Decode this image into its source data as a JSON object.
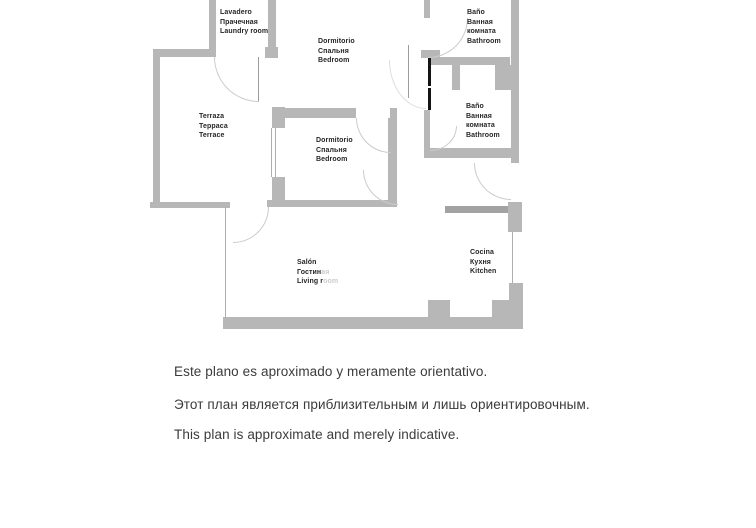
{
  "rooms": {
    "lavadero": {
      "lines": [
        "Lavadero",
        "Прачечная",
        "Laundry room"
      ]
    },
    "dormitorio1": {
      "lines": [
        "Dormitorio",
        "Спальня",
        "Bedroom"
      ]
    },
    "bano1": {
      "lines": [
        "Baño",
        "Ванная",
        "комната",
        "Bathroom"
      ]
    },
    "terraza": {
      "lines": [
        "Terraza",
        "Терраса",
        "Terrace"
      ]
    },
    "bano2": {
      "lines": [
        "Baño",
        "Ванная",
        "комната",
        "Bathroom"
      ]
    },
    "dormitorio2": {
      "lines": [
        "Dormitorio",
        "Спальня",
        "Bedroom"
      ]
    },
    "salon": {
      "lines_split": [
        [
          "Salón",
          ""
        ],
        [
          "Гостин",
          "ая"
        ],
        [
          "Living r",
          "oom"
        ]
      ]
    },
    "cocina": {
      "lines": [
        "Cocina",
        "Кухня",
        "Kitchen"
      ]
    }
  },
  "disclaimer": {
    "lines": [
      "Este plano es aproximado y meramente orientativo.",
      "Этот план является приблизительным и лишь ориентировочным.",
      "This plan is approximate and merely indicative."
    ]
  },
  "colors": {
    "background": "#ffffff",
    "wall": "#b7b7b7",
    "wall_dark": "#a2a2a2",
    "door_panel_black": "#141414",
    "door_arc": "#cbcbcb",
    "window_line": "#aeaeae",
    "label_text": "#262626",
    "label_faded": "#cccccc",
    "disclaimer_text": "#3b3b3b"
  }
}
